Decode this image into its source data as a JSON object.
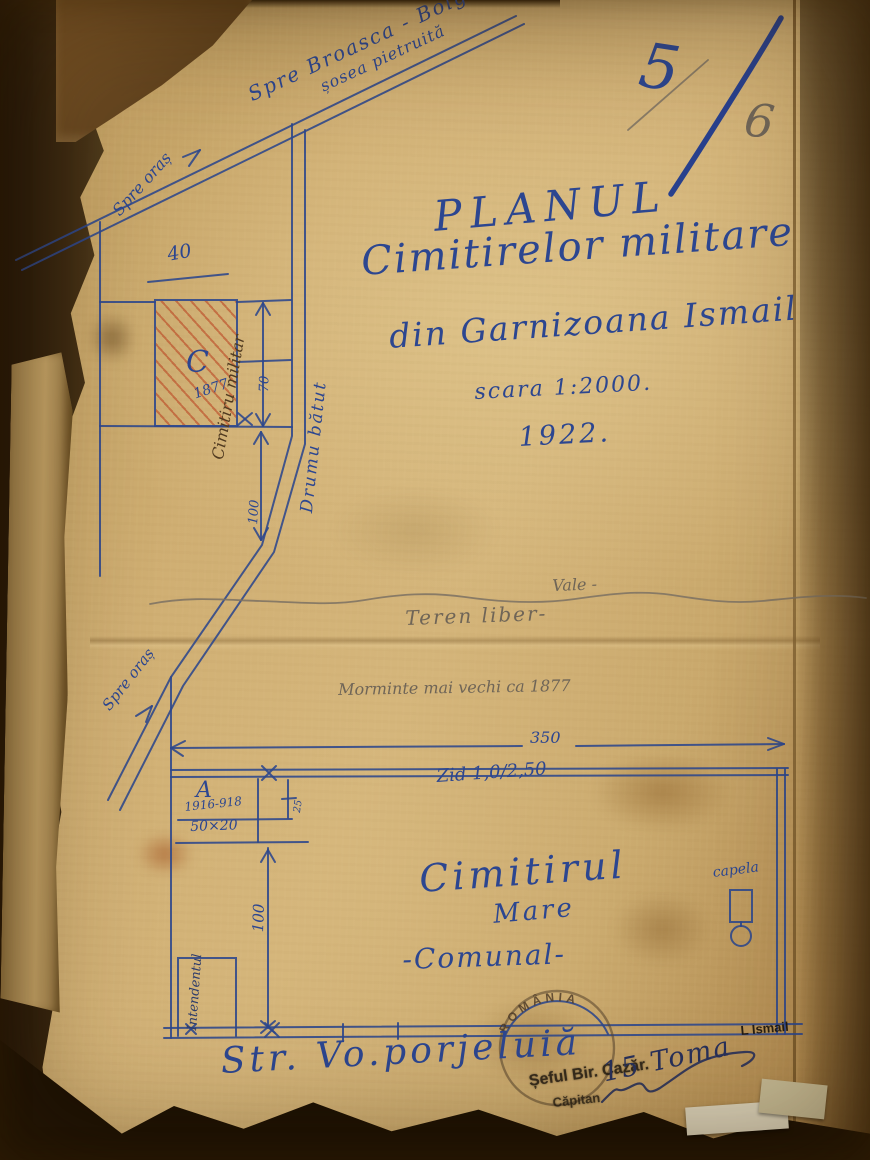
{
  "colors": {
    "ink": "#2c4690",
    "pencil": "#6f6557",
    "paper": "#c8a76d",
    "hatch_red": "#b0452a",
    "stamp_black": "#221b12"
  },
  "page": {
    "folio_crossed": "5",
    "folio": "6"
  },
  "title": {
    "main": "PLANUL",
    "line2": "Cimitirelor militare",
    "line3": "din Garnizoana Ismail",
    "scale": "scara 1:2000.",
    "year": "1922."
  },
  "roads": {
    "top_label": "Spre Broasca - Bolg",
    "top_sublabel": "șosea pietruită",
    "top_direction": "Spre oraș",
    "vertical_label": "Drumu bătut",
    "lower_direction": "Spre oraș"
  },
  "military_cemetery": {
    "letter": "C",
    "year": "1877",
    "name": "Cimitiru militar",
    "dim_top": "40",
    "dim_right": "70",
    "dim_below": "100"
  },
  "terrain": {
    "vale_label": "Vale -",
    "teren_label": "Teren liber-",
    "note": "Morminte mai vechi ca 1877"
  },
  "communal": {
    "dim_top": "350",
    "wall_label": "Zid 1,0/2,50",
    "name1": "Cimitirul",
    "name2": "Mare",
    "name3": "-Comunal-",
    "chapel_label": "capela",
    "dim_left": "100",
    "entrance_label": "Intendentul",
    "plot_a": {
      "letter": "A",
      "years": "1916-918",
      "size": "50×20",
      "dim_side": "25"
    }
  },
  "street": {
    "name": "Str. Vo.porjeluiă"
  },
  "stamps": {
    "round": "ROMÂNIA",
    "office_line1": "Șeful Bir. Cazăr.",
    "office_line2": "Căpitan",
    "signature": "15 Toma",
    "unit": "L Ismail"
  }
}
